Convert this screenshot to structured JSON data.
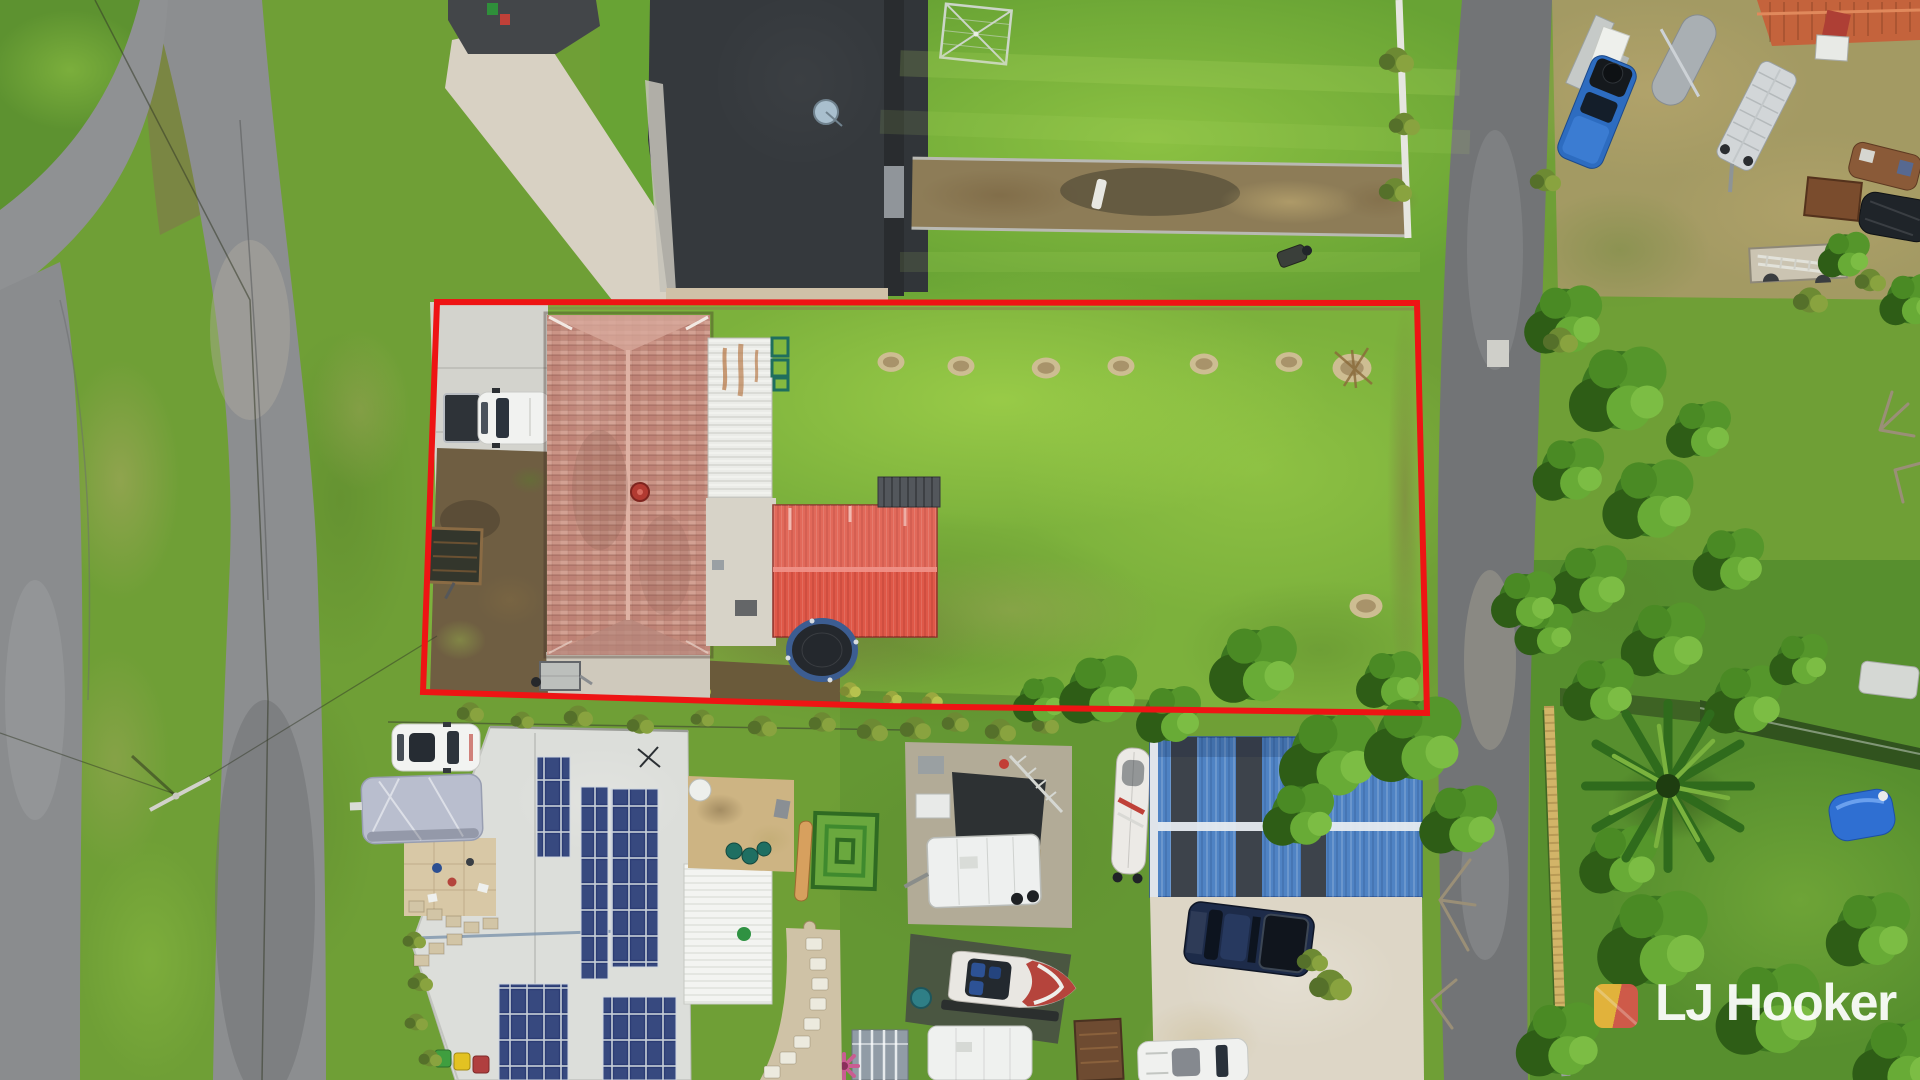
{
  "branding": {
    "logo_text": "LJ Hooker",
    "logo_mark_icon": "lj-hooker-diagonal-square-icon",
    "logo_colors": {
      "yellow": "#ECB53D",
      "red": "#D8574C",
      "text": "#FFFFFF"
    }
  },
  "overlay": {
    "boundary_points": "437,302 1417,303 1427,713 884,706 423,692",
    "boundary_color": "#EE1414",
    "boundary_stroke_width": 6
  }
}
